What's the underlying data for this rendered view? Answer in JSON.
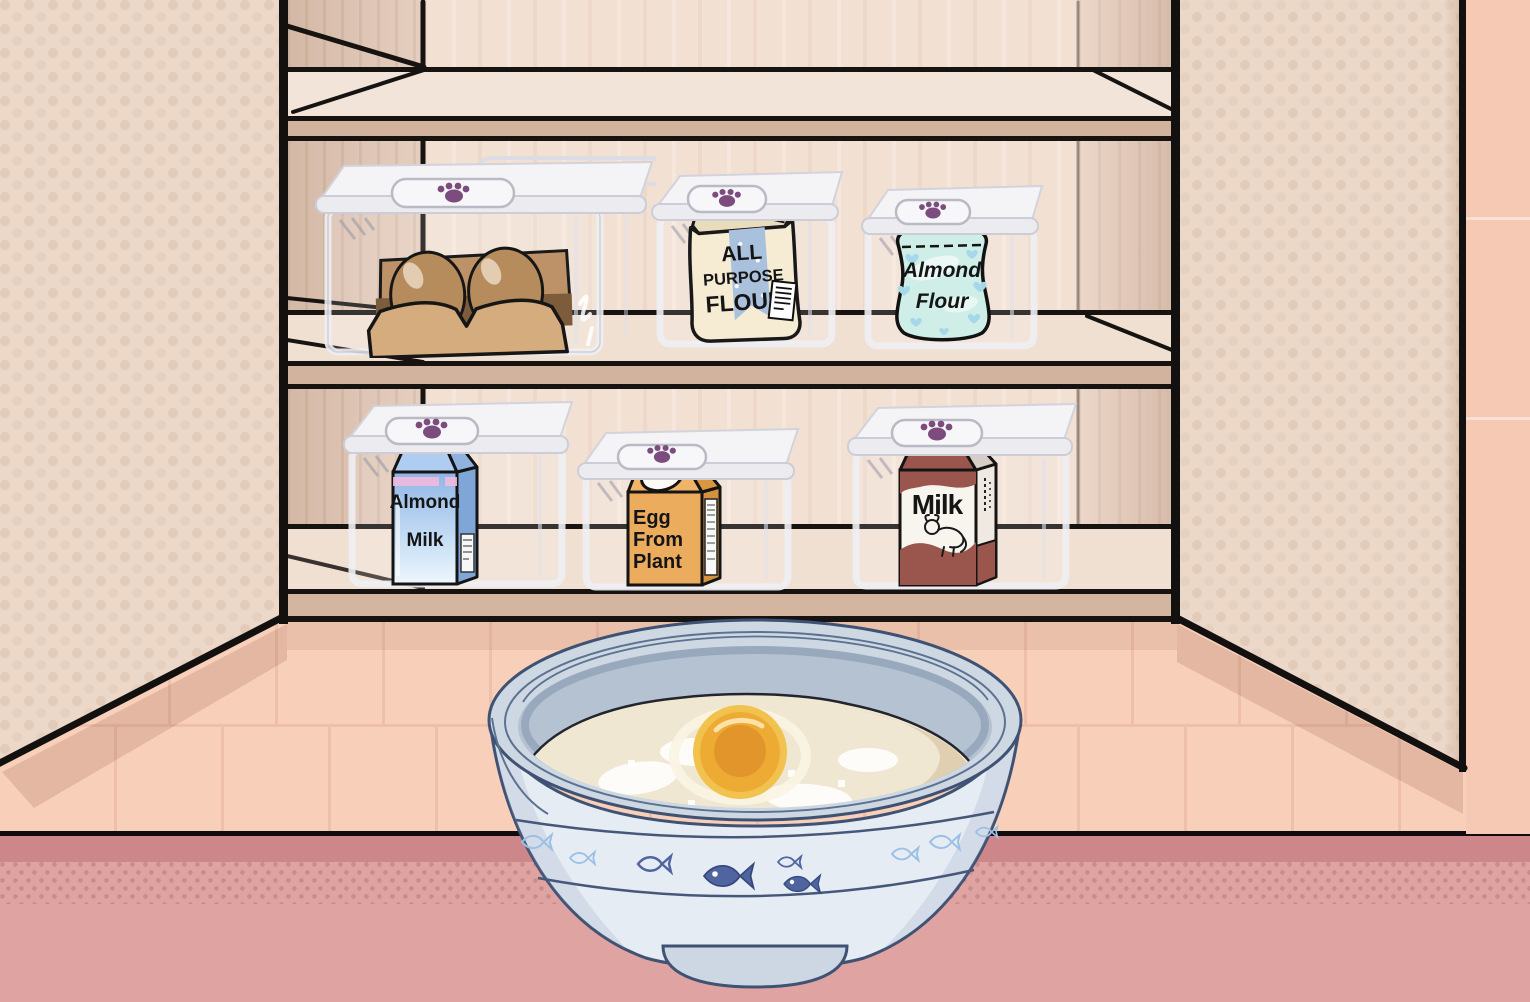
{
  "scene": {
    "description": "Cooking game: open kitchen cabinet with labeled ingredient containers above a mixing bowl of batter with an egg yolk",
    "colors": {
      "paw_accent": "#7b4c7d",
      "counter": "#dfa3a1",
      "counter_band": "#cd8689",
      "backsplash_tile": "#f8d0ba",
      "cabinet_door": "#ecd8c8",
      "cabinet_back": "#f2e0d3",
      "shelf_front": "#d2b49e",
      "outline": "#141110",
      "bowl": "#e6ecf3",
      "batter": "#f0e7d3",
      "yolk": "#eeab33"
    }
  },
  "cabinet": {
    "lid_icon": "paw-icon",
    "shelf1_items": [
      "eggs",
      "all-purpose-flour",
      "almond-flour"
    ],
    "shelf2_items": [
      "almond-milk",
      "egg-from-plant",
      "milk"
    ]
  },
  "ingredients": {
    "eggs": {
      "icon": "egg-carton-icon"
    },
    "all_purpose_flour": {
      "line1": "ALL",
      "line2": "PURPOSE",
      "line3": "FLOUR"
    },
    "almond_flour": {
      "line1": "Almond",
      "line2": "Flour"
    },
    "almond_milk": {
      "line1": "Almond",
      "line2": "Milk"
    },
    "egg_from_plant": {
      "line1": "Egg",
      "line2": "From",
      "line3": "Plant"
    },
    "milk": {
      "line1": "Milk"
    }
  },
  "bowl": {
    "contents": [
      "flour",
      "egg-yolk"
    ],
    "pattern": "fish-icons"
  }
}
